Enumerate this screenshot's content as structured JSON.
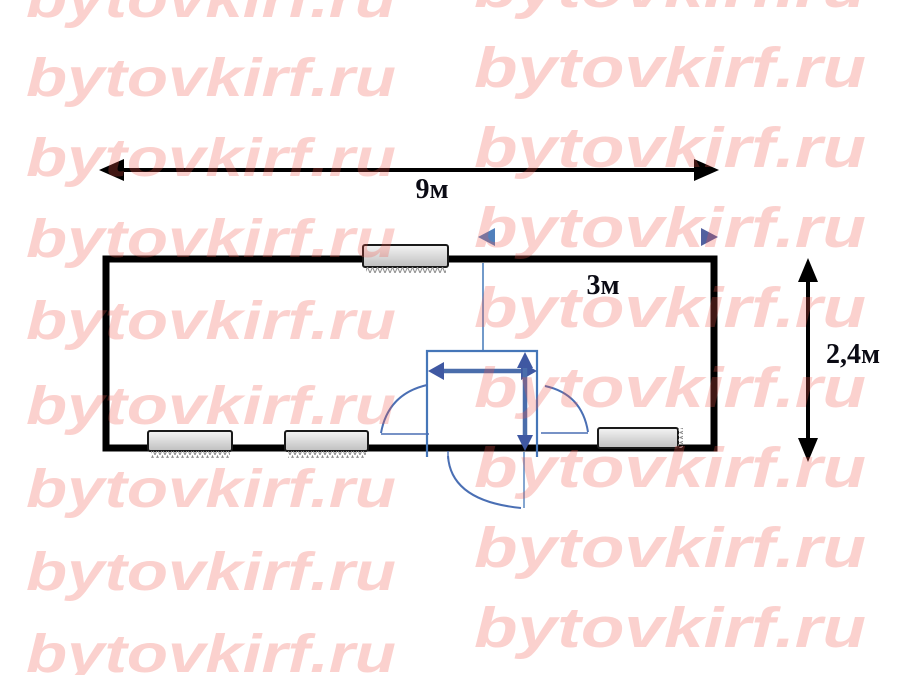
{
  "page": {
    "background": "#ffffff"
  },
  "watermark": {
    "text": "bytovkirf.ru",
    "color": "rgba(242,86,74,0.27)"
  },
  "labels": {
    "total_width": "9м",
    "room_width": "3м",
    "total_height": "2,4м"
  },
  "plan": {
    "wall_color": "#000000",
    "accent_blue": "#4f81bd",
    "arrow_blue_dark": "#3f58a2",
    "window_fill_light": "#f4f4f4",
    "window_fill_dark": "#bfbfbf",
    "hatch_color": "#8b8b8b"
  }
}
